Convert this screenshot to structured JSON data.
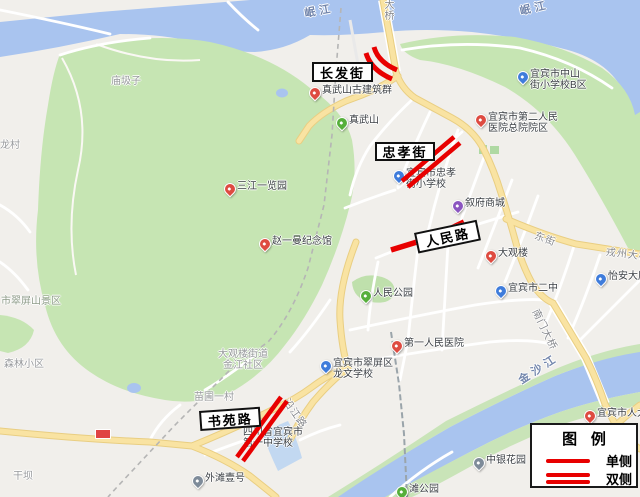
{
  "map_title": "宜宾市城区改造路段示意图",
  "legend": {
    "title": "图 例",
    "items": [
      {
        "label": "单侧",
        "type": "single"
      },
      {
        "label": "双侧",
        "type": "double"
      }
    ]
  },
  "marks": [
    {
      "road": "长发街",
      "sides": "双侧",
      "shape": "curved"
    },
    {
      "road": "忠孝街",
      "sides": "双侧",
      "shape": "straight"
    },
    {
      "road": "人民路",
      "sides": "单侧",
      "shape": "straight"
    },
    {
      "road": "书苑路",
      "sides": "双侧",
      "shape": "straight"
    }
  ],
  "road_boxes": [
    {
      "id": "changfajie",
      "text": "长发街",
      "x": 312,
      "y": 62,
      "w": 57,
      "h": 16,
      "rot": 0
    },
    {
      "id": "zhongxiaojie",
      "text": "忠孝街",
      "x": 375,
      "y": 142,
      "w": 56,
      "h": 15,
      "rot": 0
    },
    {
      "id": "renminlu",
      "text": "人民路",
      "x": 414,
      "y": 233,
      "w": 60,
      "h": 17,
      "rot": -12
    },
    {
      "id": "shuyuanlu",
      "text": "书苑路",
      "x": 199,
      "y": 411,
      "w": 57,
      "h": 16,
      "rot": -4
    }
  ],
  "water_labels": [
    {
      "id": "minjiang-west",
      "text": "岷江",
      "x": 303,
      "y": 5,
      "rot": -10
    },
    {
      "id": "minjiang-east",
      "text": "岷江",
      "x": 518,
      "y": 3,
      "rot": -13
    },
    {
      "id": "jinshajiang",
      "text": "金沙江",
      "x": 515,
      "y": 374,
      "rot": -33
    }
  ],
  "road_labels": [
    {
      "id": "daqiao",
      "text": "大桥",
      "x": 383,
      "y": 1,
      "rot": 0,
      "vertical": true
    },
    {
      "id": "dongjie",
      "text": "东街",
      "x": 538,
      "y": 227,
      "rot": 20
    },
    {
      "id": "nanmen-bridge",
      "text": "南门大桥",
      "x": 543,
      "y": 306,
      "rot": 64
    },
    {
      "id": "yanjianglu",
      "text": "沿江路",
      "x": 293,
      "y": 395,
      "rot": 55
    },
    {
      "id": "rongzhou-bridge",
      "text": "戎州大桥",
      "x": 607,
      "y": 243,
      "rot": 7
    }
  ],
  "area_labels": [
    {
      "id": "miaojizi",
      "text": "庙圾子",
      "x": 111,
      "y": 72,
      "scenic": false
    },
    {
      "id": "longcun",
      "text": "龙村",
      "x": 0,
      "y": 136,
      "scenic": false
    },
    {
      "id": "cuipingshan",
      "text": "市翠屏山景区",
      "x": 1,
      "y": 292,
      "scenic": true
    },
    {
      "id": "senlin",
      "text": "森林小区",
      "x": 4,
      "y": 355,
      "scenic": false
    },
    {
      "id": "ganba",
      "text": "干坝",
      "x": 13,
      "y": 467,
      "scenic": false
    },
    {
      "id": "miaopu",
      "text": "苗圃一村",
      "x": 194,
      "y": 388,
      "scenic": false
    },
    {
      "id": "daguanlou-jiedao",
      "text": "大观楼街道 金江社区",
      "x": 215,
      "y": 349,
      "scenic": false,
      "two_line": true
    }
  ],
  "pois": [
    {
      "id": "zhenwushan-guild",
      "color": "red",
      "x": 309,
      "y": 87,
      "lines": [
        "真武山古建筑群"
      ]
    },
    {
      "id": "zhenwushan",
      "color": "green",
      "x": 336,
      "y": 117,
      "lines": [
        "真武山"
      ]
    },
    {
      "id": "sanjiang-park",
      "color": "red",
      "x": 224,
      "y": 183,
      "lines": [
        "三江一览园"
      ]
    },
    {
      "id": "zhaoyiman-memorial",
      "color": "red",
      "x": 259,
      "y": 238,
      "lines": [
        "赵一曼纪念馆"
      ]
    },
    {
      "id": "renmin-park",
      "color": "green",
      "x": 360,
      "y": 290,
      "lines": [
        "人民公园"
      ]
    },
    {
      "id": "zhongshan-school",
      "color": "blue",
      "x": 517,
      "y": 71,
      "lines": [
        "宜宾市中山",
        "街小学校B区"
      ]
    },
    {
      "id": "second-hospital",
      "color": "red",
      "x": 475,
      "y": 114,
      "lines": [
        "宜宾市第二人民",
        "医院总院院区"
      ]
    },
    {
      "id": "zhongxiao-school",
      "color": "blue",
      "x": 393,
      "y": 170,
      "lines": [
        "宜宾市忠孝",
        "街小学校"
      ]
    },
    {
      "id": "xufu-mall",
      "color": "purple",
      "x": 452,
      "y": 200,
      "lines": [
        "叙府商城"
      ]
    },
    {
      "id": "daguanlou",
      "color": "red",
      "x": 485,
      "y": 250,
      "lines": [
        "大观楼"
      ]
    },
    {
      "id": "erzhong",
      "color": "blue",
      "x": 495,
      "y": 285,
      "lines": [
        "宜宾市二中"
      ]
    },
    {
      "id": "yian-building",
      "color": "blue",
      "x": 595,
      "y": 273,
      "lines": [
        "怡安大厦"
      ]
    },
    {
      "id": "first-hospital",
      "color": "red",
      "x": 391,
      "y": 340,
      "lines": [
        "第一人民医院"
      ]
    },
    {
      "id": "longwen-school",
      "color": "blue",
      "x": 320,
      "y": 360,
      "lines": [
        "宜宾市翠屏区",
        "龙文学校"
      ]
    },
    {
      "id": "yizhong",
      "color": "none",
      "x": 243,
      "y": 429,
      "lines": [
        "四川省宜宾市",
        "第一中学校"
      ]
    },
    {
      "id": "zhongyin-garden",
      "color": "gray",
      "x": 473,
      "y": 457,
      "lines": [
        "中银花园"
      ]
    },
    {
      "id": "waitan-no1",
      "color": "gray",
      "x": 192,
      "y": 475,
      "lines": [
        "外滩壹号"
      ]
    },
    {
      "id": "renda",
      "color": "red",
      "x": 584,
      "y": 410,
      "lines": [
        "宜宾市人大"
      ]
    },
    {
      "id": "tan-park",
      "color": "green",
      "x": 396,
      "y": 486,
      "lines": [
        "滩公园"
      ]
    }
  ],
  "colors": {
    "mark_red": "#E80000",
    "water": "#A9C4EF",
    "park_green": "#C6E5B3",
    "road_yellow": "#F9E3A2",
    "legend_border": "#1a1a1a"
  }
}
